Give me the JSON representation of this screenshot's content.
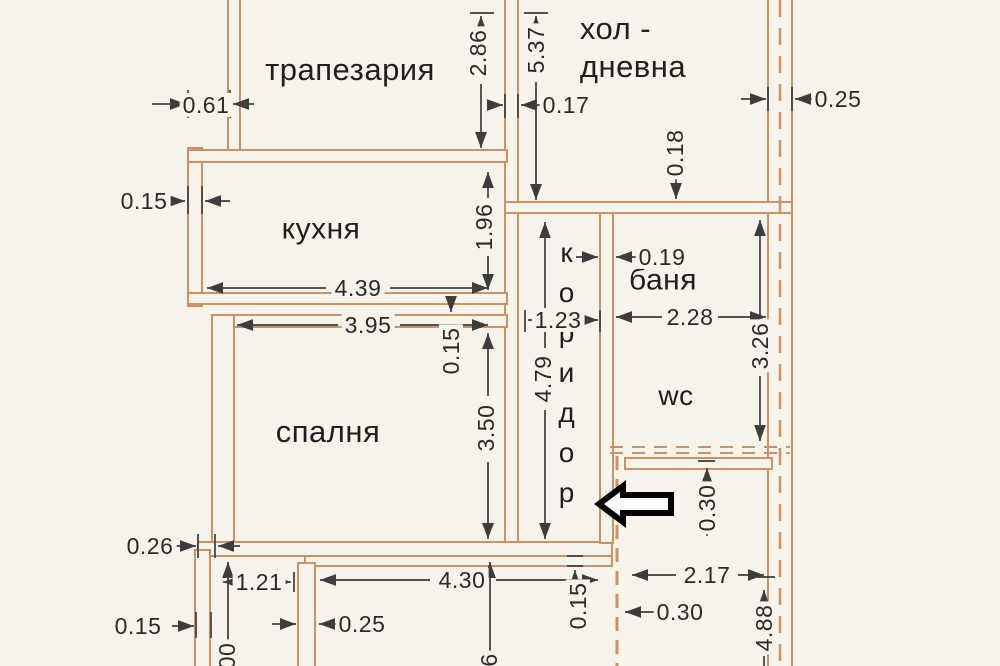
{
  "document": {
    "type": "scanned apartment floor plan",
    "language": "bulgarian"
  },
  "colors": {
    "paper": "#f6f3ea",
    "wall": "#cc9166",
    "dim_line": "#3d3d3d",
    "text": "#1f1f1f",
    "arrow": "#000000"
  },
  "rooms": [
    {
      "id": "trapezaria",
      "label": "трапезария",
      "x": 350,
      "y": 70,
      "size": 31
    },
    {
      "id": "hol-dnevna",
      "label": "хол -\nдневна",
      "x": 633,
      "y": 48,
      "size": 31,
      "align": "left"
    },
    {
      "id": "kuhnya",
      "label": "кухня",
      "x": 321,
      "y": 230,
      "size": 30
    },
    {
      "id": "spalnya",
      "label": "спалня",
      "x": 328,
      "y": 432,
      "size": 31
    },
    {
      "id": "banya",
      "label": "баня",
      "x": 663,
      "y": 281,
      "size": 30
    },
    {
      "id": "wc",
      "label": "wc",
      "x": 676,
      "y": 396,
      "size": 28
    },
    {
      "id": "koridor",
      "label": "коридор",
      "x": 566,
      "y": 377,
      "size": 28,
      "vertical": true
    }
  ],
  "dimensions": [
    {
      "id": "d-061",
      "label": "0.61",
      "x": 206,
      "y": 105
    },
    {
      "id": "d-015-left",
      "label": "0.15",
      "x": 144,
      "y": 201
    },
    {
      "id": "d-286",
      "label": "2.86",
      "x": 478,
      "y": 53,
      "rotated": true
    },
    {
      "id": "d-537",
      "label": "5.37",
      "x": 536,
      "y": 50,
      "rotated": true
    },
    {
      "id": "d-017",
      "label": "0.17",
      "x": 566,
      "y": 105
    },
    {
      "id": "d-018",
      "label": "0.18",
      "x": 675,
      "y": 153,
      "rotated": true
    },
    {
      "id": "d-025-top",
      "label": "0.25",
      "x": 838,
      "y": 99
    },
    {
      "id": "d-196",
      "label": "1.96",
      "x": 484,
      "y": 227,
      "rotated": true
    },
    {
      "id": "d-439",
      "label": "4.39",
      "x": 358,
      "y": 288
    },
    {
      "id": "d-395",
      "label": "3.95",
      "x": 368,
      "y": 325
    },
    {
      "id": "d-015-mid",
      "label": "0.15",
      "x": 451,
      "y": 351,
      "rotated": true
    },
    {
      "id": "d-123",
      "label": "1.23",
      "x": 558,
      "y": 320
    },
    {
      "id": "d-019",
      "label": "0.19",
      "x": 662,
      "y": 257
    },
    {
      "id": "d-228",
      "label": "2.28",
      "x": 690,
      "y": 317
    },
    {
      "id": "d-326",
      "label": "3.26",
      "x": 760,
      "y": 346,
      "rotated": true
    },
    {
      "id": "d-479",
      "label": "4.79",
      "x": 543,
      "y": 379,
      "rotated": true
    },
    {
      "id": "d-350",
      "label": "3.50",
      "x": 486,
      "y": 428,
      "rotated": true
    },
    {
      "id": "d-030-mid",
      "label": "0.30",
      "x": 707,
      "y": 508,
      "rotated": true
    },
    {
      "id": "d-026",
      "label": "0.26",
      "x": 150,
      "y": 546
    },
    {
      "id": "d-121",
      "label": "1.21",
      "x": 259,
      "y": 582
    },
    {
      "id": "d-015-bl",
      "label": "0.15",
      "x": 138,
      "y": 626
    },
    {
      "id": "d-025-b",
      "label": "0.25",
      "x": 362,
      "y": 624
    },
    {
      "id": "d-430",
      "label": "4.30",
      "x": 462,
      "y": 580
    },
    {
      "id": "d-217",
      "label": "2.17",
      "x": 707,
      "y": 575
    },
    {
      "id": "d-030-br",
      "label": "0.30",
      "x": 680,
      "y": 612
    },
    {
      "id": "d-488",
      "label": "4.88",
      "x": 764,
      "y": 628,
      "rotated": true
    },
    {
      "id": "d-015-bc",
      "label": "0.15",
      "x": 578,
      "y": 606,
      "rotated": true
    },
    {
      "id": "d-cut-00",
      "label": "00",
      "x": 227,
      "y": 656,
      "rotated": true
    },
    {
      "id": "d-cut-6",
      "label": "6",
      "x": 489,
      "y": 660,
      "rotated": true
    }
  ],
  "annotations": {
    "entrance_arrow": "black outlined arrow pointing left at corridor entrance"
  }
}
